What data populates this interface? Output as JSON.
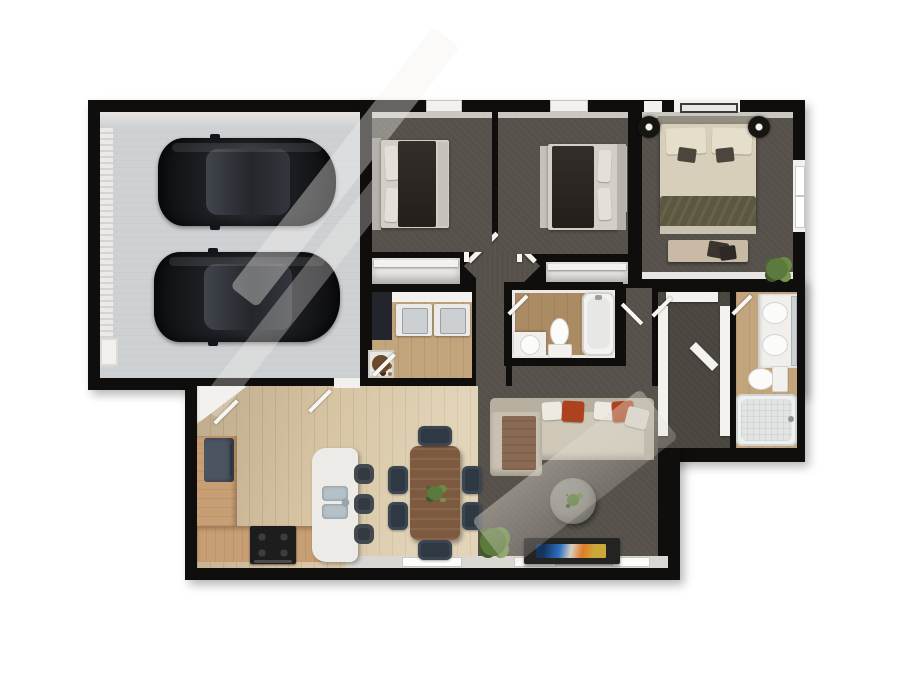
{
  "title": "3D Top-Down Floor Plan",
  "palette": {
    "wall": "#0f0e0c",
    "outside": "#ffffff",
    "garage-floor": "#ced1d3",
    "carpet": "#55504a",
    "carpet-dark": "#4a453f",
    "wood-light": "#d7c5a4",
    "wood-mid": "#c2a57c",
    "wood-dark": "#ab8b64",
    "white-int": "#f2f1ee",
    "sill": "#d9d7d2",
    "counter": "#c89e74",
    "island": "#edebe7",
    "sink-blue": "#b5c1c8",
    "fridge": "#4b5461",
    "stove": "#1d1d1d",
    "stool": "#333a41",
    "table": "#7d5a3f",
    "chair": "#2e3944",
    "sofa": "#cfc8b9",
    "sofa-back": "#b7afa0",
    "red": "#ad421e",
    "throw": "#8a6a52",
    "ottoman": "#8e8b84",
    "bed-dark": "#2b2723",
    "bed-frame": "#c6c1ba",
    "pillow": "#e3e0da",
    "master-bed": "#d8cfba",
    "olive": "#5c5840",
    "bench": "#c8baa5",
    "green": "#5d7a3e",
    "tv": "#232323"
  },
  "rooms": [
    {
      "id": "garage",
      "name": "Garage (2-car)"
    },
    {
      "id": "bedroom-a",
      "name": "Bedroom 2"
    },
    {
      "id": "bedroom-b",
      "name": "Bedroom 3"
    },
    {
      "id": "master-bedroom",
      "name": "Master Bedroom"
    },
    {
      "id": "closet-a",
      "name": "Bedroom 2 Closet"
    },
    {
      "id": "closet-b",
      "name": "Bedroom 3 Closet"
    },
    {
      "id": "laundry",
      "name": "Laundry Room"
    },
    {
      "id": "hallway",
      "name": "Hallway"
    },
    {
      "id": "hall-bathroom",
      "name": "Hall Bathroom"
    },
    {
      "id": "walk-in-closet",
      "name": "Walk-in Closet"
    },
    {
      "id": "master-bathroom",
      "name": "Master Bathroom"
    },
    {
      "id": "kitchen",
      "name": "Kitchen"
    },
    {
      "id": "dining-area",
      "name": "Dining Area"
    },
    {
      "id": "living-room",
      "name": "Living Room"
    }
  ],
  "furniture": {
    "car": "Black car",
    "bed": "Bed",
    "master_bed": "King bed with bench",
    "sofa": "Sectional sofa",
    "ottoman": "Round ottoman",
    "tv_console": "TV media console",
    "dining_table": "Dining table with 6 chairs",
    "island": "Kitchen island with sink",
    "refrigerator": "Refrigerator",
    "stove": "Range / stove",
    "bar_stool": "Bar stool",
    "washer": "Washer",
    "dryer": "Dryer",
    "toilet": "Toilet",
    "bathtub": "Bathtub",
    "vanity": "Vanity sink",
    "plant": "Potted plant",
    "garage_door": "Garage door",
    "window": "Window",
    "door": "Interior door"
  }
}
